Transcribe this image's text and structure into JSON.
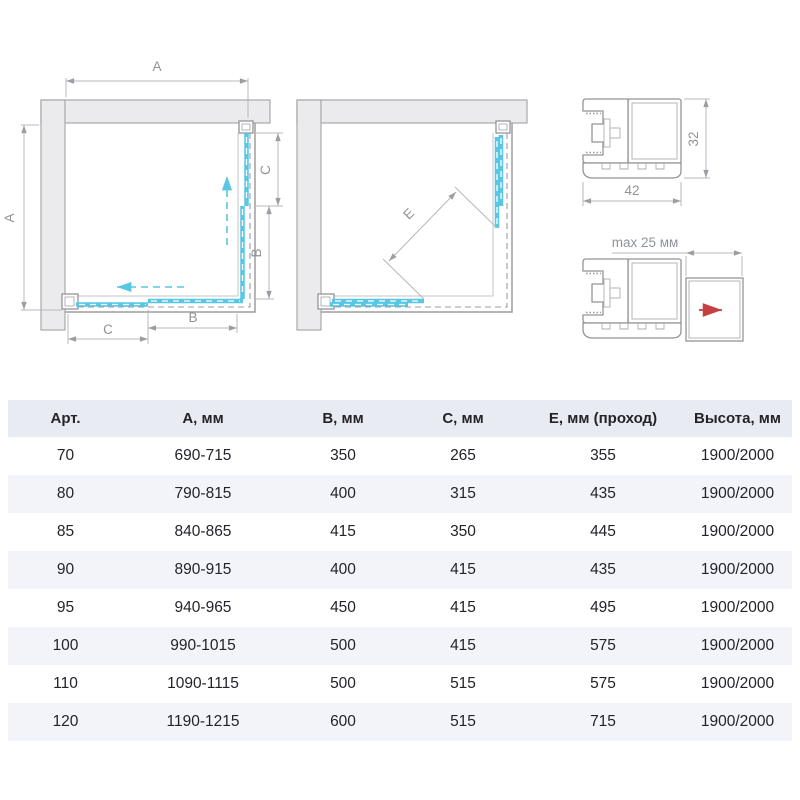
{
  "colors": {
    "glass_blue": "#59c6e3",
    "arrow_red": "#c64040",
    "wall_fill": "#ebebee",
    "wall_stroke": "#a8a8ac",
    "frame_gray": "#9d9da1",
    "dim_gray": "#b5b8bc",
    "label_gray": "#8f9398",
    "header_bg": "#e9ebf3",
    "row_alt_bg": "#f3f4fa",
    "text_dark": "#232329"
  },
  "diagrams": {
    "closed": {
      "a_top": "A",
      "a_left": "A",
      "c_right": "C",
      "b_right": "B",
      "c_bottom": "C",
      "b_bottom": "B"
    },
    "open": {
      "e": "E"
    },
    "profile": {
      "width_label": "42",
      "height_label": "32"
    },
    "extension": {
      "max_label": "max 25 мм"
    }
  },
  "table": {
    "headers": [
      "Арт.",
      "А, мм",
      "В, мм",
      "С, мм",
      "Е, мм (проход)",
      "Высота, мм"
    ],
    "rows": [
      [
        "70",
        "690-715",
        "350",
        "265",
        "355",
        "1900/2000"
      ],
      [
        "80",
        "790-815",
        "400",
        "315",
        "435",
        "1900/2000"
      ],
      [
        "85",
        "840-865",
        "415",
        "350",
        "445",
        "1900/2000"
      ],
      [
        "90",
        "890-915",
        "400",
        "415",
        "435",
        "1900/2000"
      ],
      [
        "95",
        "940-965",
        "450",
        "415",
        "495",
        "1900/2000"
      ],
      [
        "100",
        "990-1015",
        "500",
        "415",
        "575",
        "1900/2000"
      ],
      [
        "110",
        "1090-1115",
        "500",
        "515",
        "575",
        "1900/2000"
      ],
      [
        "120",
        "1190-1215",
        "600",
        "515",
        "715",
        "1900/2000"
      ]
    ]
  }
}
